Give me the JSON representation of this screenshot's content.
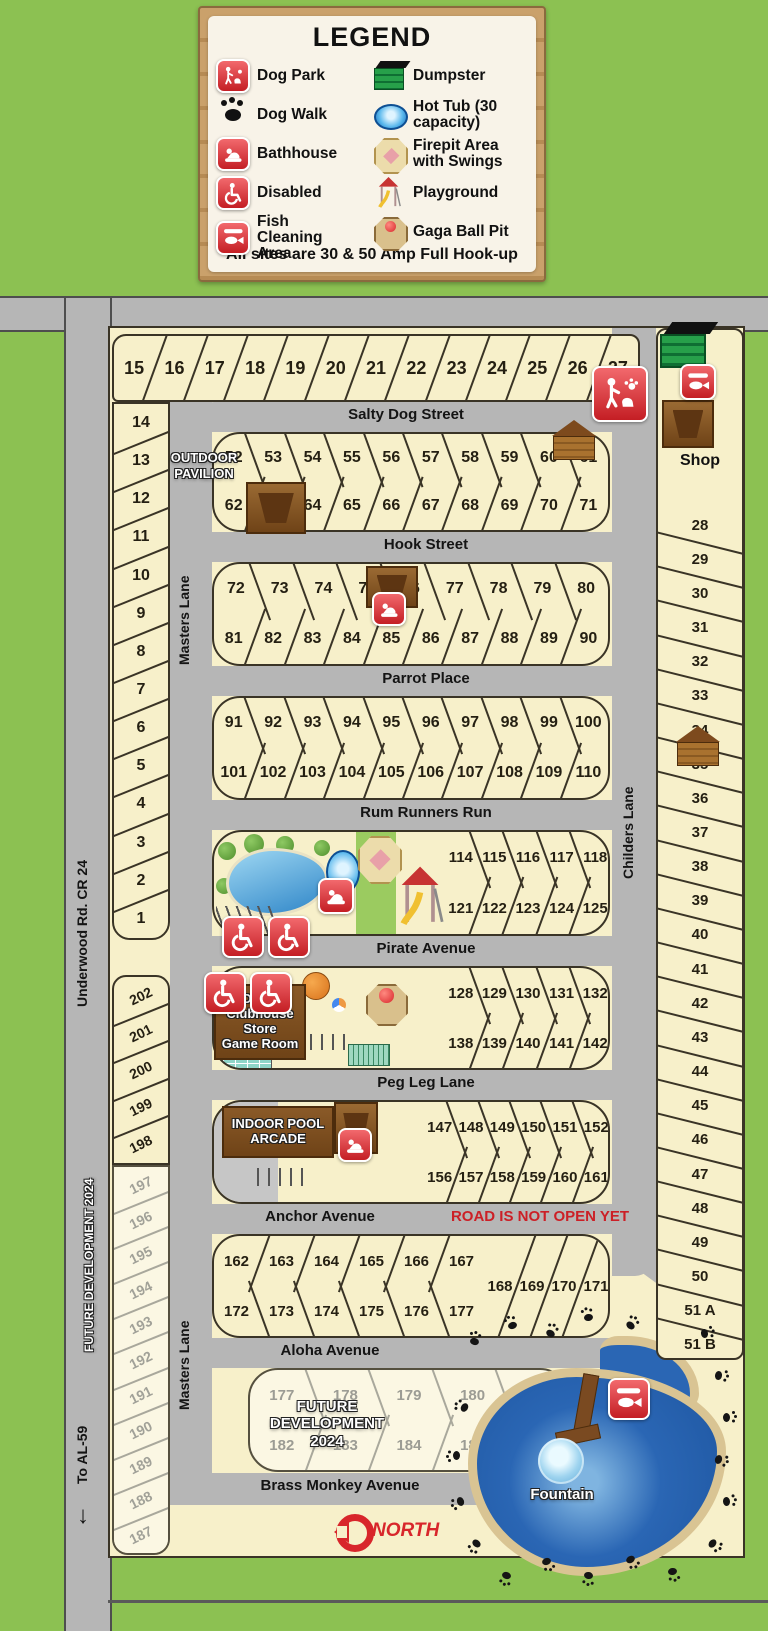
{
  "colors": {
    "background_green": "#8cc152",
    "road_gray": "#b6b6b6",
    "site_cream": "#f7f0ca",
    "future_cream": "#fbf7e3",
    "pond_blue": "#2a66b4",
    "accent_red": "#d8262b"
  },
  "legend": {
    "title": "LEGEND",
    "footer": "All sites are 30 & 50 Amp Full Hook-up",
    "items_left": [
      {
        "icon": "dog-park-icon",
        "label": "Dog Park"
      },
      {
        "icon": "dog-walk-paw-icon",
        "label": "Dog Walk"
      },
      {
        "icon": "bathhouse-icon",
        "label": "Bathhouse"
      },
      {
        "icon": "disabled-icon",
        "label": "Disabled"
      },
      {
        "icon": "fish-cleaning-icon",
        "label": "Fish Cleaning Area"
      }
    ],
    "items_right": [
      {
        "icon": "dumpster-icon",
        "label": "Dumpster"
      },
      {
        "icon": "hot-tub-icon",
        "label": "Hot Tub (30 capacity)"
      },
      {
        "icon": "firepit-icon",
        "label": "Firepit Area with Swings"
      },
      {
        "icon": "playground-icon",
        "label": "Playground"
      },
      {
        "icon": "gaga-ball-icon",
        "label": "Gaga Ball Pit"
      }
    ]
  },
  "roads": {
    "salty_dog": "Salty Dog Street",
    "hook": "Hook Street",
    "parrot": "Parrot Place",
    "rum_runners": "Rum Runners Run",
    "pirate": "Pirate Avenue",
    "peg_leg": "Peg Leg Lane",
    "anchor": "Anchor Avenue",
    "aloha": "Aloha Avenue",
    "brass_monkey": "Brass Monkey Avenue",
    "masters": "Masters Lane",
    "childers": "Childers Lane",
    "underwood": "Underwood Rd. CR 24",
    "to_al59": "To AL-59",
    "not_open": "ROAD IS NOT OPEN YET"
  },
  "labels": {
    "outdoor_pavilion_1": "OUTDOOR",
    "outdoor_pavilion_2": "PAVILION",
    "office_lines": [
      "Office",
      "Clubhouse",
      "Store",
      "Game Room"
    ],
    "indoor_pool_1": "INDOOR POOL",
    "indoor_pool_2": "ARCADE",
    "future_dev_vertical": "FUTURE DEVELOPMENT 2024",
    "future_1": "FUTURE",
    "future_2": "DEVELOPMENT",
    "future_3": "2024",
    "shop": "Shop",
    "fountain": "Fountain",
    "north": "NORTH"
  },
  "sites": {
    "top_row": [
      "15",
      "16",
      "17",
      "18",
      "19",
      "20",
      "21",
      "22",
      "23",
      "24",
      "25",
      "26",
      "27"
    ],
    "left_col": [
      "14",
      "13",
      "12",
      "11",
      "10",
      "9",
      "8",
      "7",
      "6",
      "5",
      "4",
      "3",
      "2",
      "1"
    ],
    "row_52": [
      "52",
      "53",
      "54",
      "55",
      "56",
      "57",
      "58",
      "59",
      "60",
      "61"
    ],
    "row_62": [
      "62",
      "63",
      "64",
      "65",
      "66",
      "67",
      "68",
      "69",
      "70",
      "71"
    ],
    "row_72": [
      "72",
      "73",
      "74",
      "75",
      "76",
      "77",
      "78",
      "79",
      "80"
    ],
    "row_81": [
      "81",
      "82",
      "83",
      "84",
      "85",
      "86",
      "87",
      "88",
      "89",
      "90"
    ],
    "row_91": [
      "91",
      "92",
      "93",
      "94",
      "95",
      "96",
      "97",
      "98",
      "99",
      "100"
    ],
    "row_101": [
      "101",
      "102",
      "103",
      "104",
      "105",
      "106",
      "107",
      "108",
      "109",
      "110"
    ],
    "row_114": [
      "114",
      "115",
      "116",
      "117",
      "118"
    ],
    "row_121": [
      "121",
      "122",
      "123",
      "124",
      "125"
    ],
    "row_128": [
      "128",
      "129",
      "130",
      "131",
      "132"
    ],
    "row_138": [
      "138",
      "139",
      "140",
      "141",
      "142"
    ],
    "row_147": [
      "147",
      "148",
      "149",
      "150",
      "151",
      "152"
    ],
    "row_156": [
      "156",
      "157",
      "158",
      "159",
      "160",
      "161"
    ],
    "row_162": [
      "162",
      "163",
      "164",
      "165",
      "166",
      "167"
    ],
    "row_172": [
      "172",
      "173",
      "174",
      "175",
      "176",
      "177"
    ],
    "row_168": [
      "168",
      "169",
      "170",
      "171"
    ],
    "future_top": [
      "177",
      "178",
      "179",
      "180",
      "181"
    ],
    "future_bottom": [
      "182",
      "183",
      "184",
      "185",
      "186"
    ],
    "right_col": [
      "28",
      "29",
      "30",
      "31",
      "32",
      "33",
      "34",
      "35",
      "36",
      "37",
      "38",
      "39",
      "40",
      "41",
      "42",
      "43",
      "44",
      "45",
      "46",
      "47",
      "48",
      "49",
      "50",
      "51 A",
      "51 B"
    ],
    "left_lower": [
      "202",
      "201",
      "200",
      "199",
      "198"
    ],
    "left_lower_future": [
      "197",
      "196",
      "195",
      "194",
      "193",
      "192",
      "191",
      "190",
      "189",
      "188",
      "187"
    ]
  }
}
